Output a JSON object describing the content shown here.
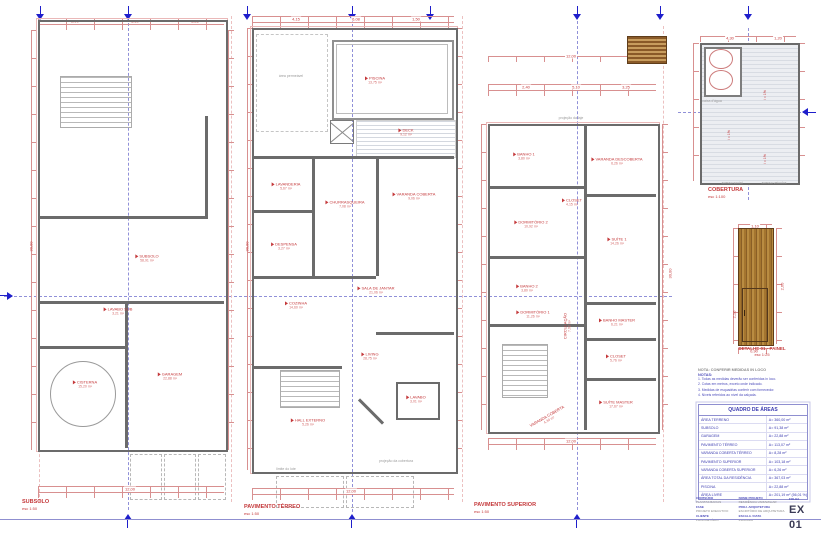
{
  "colors": {
    "dim_red": "#c4393b",
    "marker_blue": "#1e1ecb",
    "table_blue": "#3b3bb0",
    "wall_gray": "#6b6b6b",
    "wood_brown": "#9a6a2e",
    "centerline": "#9090d8"
  },
  "plans": [
    {
      "title": "SUBSOLO",
      "scale": "esc 1:50",
      "rooms": [
        {
          "name": "SUBSOLO",
          "area": "58,91 m²"
        },
        {
          "name": "LAVABO SUB",
          "area": "3,21 m²"
        },
        {
          "name": "CISTERNA",
          "area": "15,20 m²"
        },
        {
          "name": "GARAGEM",
          "area": "22,88 m²"
        }
      ]
    },
    {
      "title": "PAVIMENTO TÉRREO",
      "scale": "esc 1:50",
      "rooms": [
        {
          "name": "PISCINA",
          "area": "13,75 m²"
        },
        {
          "name": "DECK",
          "area": "9,12 m²"
        },
        {
          "name": "LAVANDERIA",
          "area": "5,67 m²"
        },
        {
          "name": "DESPENSA",
          "area": "3,27 m²"
        },
        {
          "name": "CHURRASQUEIRA",
          "area": "7,08 m²"
        },
        {
          "name": "VARANDA COBERTA",
          "area": "9,06 m²"
        },
        {
          "name": "SALA DE JANTAR",
          "area": "21,06 m²"
        },
        {
          "name": "COZINHA",
          "area": "14,60 m²"
        },
        {
          "name": "LIVING",
          "area": "28,75 m²"
        },
        {
          "name": "HALL EXTERNO",
          "area": "5,26 m²"
        },
        {
          "name": "LAVABO",
          "area": "3,01 m²"
        }
      ]
    },
    {
      "title": "PAVIMENTO SUPERIOR",
      "scale": "esc 1:50",
      "rooms": [
        {
          "name": "VARANDA DESCOBERTA",
          "area": "6,26 m²"
        },
        {
          "name": "BANHO 1",
          "area": "3,80 m²"
        },
        {
          "name": "CLOSET",
          "area": "4,15 m²"
        },
        {
          "name": "SUÍTE 1",
          "area": "14,26 m²"
        },
        {
          "name": "DORMITÓRIO 2",
          "area": "10,92 m²"
        },
        {
          "name": "BANHO 2",
          "area": "3,80 m²"
        },
        {
          "name": "BANHO MASTER",
          "area": "6,21 m²"
        },
        {
          "name": "DORMITÓRIO 1",
          "area": "11,26 m²"
        },
        {
          "name": "CIRCULAÇÃO",
          "area": "7,92 m²"
        },
        {
          "name": "CLOSET",
          "area": "5,76 m²"
        },
        {
          "name": "SUÍTE MASTER",
          "area": "17,67 m²"
        },
        {
          "name": "VARANDA COBERTA",
          "area": "4,30 m²"
        }
      ]
    }
  ],
  "cobertura": {
    "title": "COBERTURA",
    "scale": "esc 1:100",
    "slopes": [
      "i = 1%",
      "i = 1%",
      "i = 1%"
    ]
  },
  "detail": {
    "title": "DETALHE 01 - PAINEL",
    "scale": "esc 1:25"
  },
  "annotations": {
    "permeavel": "área permeável",
    "proj_cobertura": "projeção da cobertura",
    "limite": "limite do lote",
    "proj_laje": "projeção da laje",
    "acesso_social": "acesso social",
    "acesso_veiculos": "acesso veículos",
    "caixa_dagua": "caixa d'água"
  },
  "notes": {
    "heading": "NOTA: CONFERIR MEDIDAS IN LOCO",
    "label": "NOTAS:",
    "items": [
      "1. Todas as medidas deverão ser conferidas in loco.",
      "2. Cotas em metros, exceto onde indicado.",
      "3. Medidas de esquadrias conferir com fornecedor.",
      "4. Níveis referidos ao nível da calçada."
    ]
  },
  "areas_table": {
    "title": "QUADRO DE ÁREAS",
    "rows": [
      {
        "label": "ÁREA TERRENO",
        "value": "A= 360,00 m²"
      },
      {
        "label": "SUBSOLO",
        "value": "A= 91,38 m²"
      },
      {
        "label": "GARAGEM",
        "value": "A= 22,88 m²"
      },
      {
        "label": "PAVIMENTO TÉRREO",
        "value": "A= 113,07 m²"
      },
      {
        "label": "VARANDA COBERTA TÉRREO",
        "value": "A= 8,28 m²"
      },
      {
        "label": "PAVIMENTO SUPERIOR",
        "value": "A= 103,18 m²"
      },
      {
        "label": "VARANDA COBERTA SUPERIOR",
        "value": "A= 6,26 m²"
      },
      {
        "label": "ÁREA TOTAL DA RESIDÊNCIA",
        "value": "A= 367,03 m²"
      },
      {
        "label": "PISCINA",
        "value": "A= 22,88 m²"
      },
      {
        "label": "ÁREA LIVRE",
        "value": "A= 201,19 m² (56,01 %)"
      }
    ]
  },
  "titleblock": {
    "folha_label": "FOLHA",
    "sheet_number": "EX 01",
    "fields": [
      {
        "label": "CONTEÚDO",
        "value": "PLANTAS BAIXAS"
      },
      {
        "label": "FASE",
        "value": "PROJETO EXECUTIVO"
      },
      {
        "label": "CLIENTE",
        "value": "PROPRIETÁRIO"
      },
      {
        "label": "NOME PROJETO",
        "value": "RESIDÊNCIA UNIFAMILIAR"
      },
      {
        "label": "PROJ. ARQUITETURA",
        "value": "ESCRITÓRIO DE ARQUITETURA"
      },
      {
        "label": "ESCALA / DATA",
        "value": "INDICADA"
      }
    ]
  },
  "dims": [
    "2,90",
    "5,10",
    "3,25",
    "12,00",
    "30,00",
    "1,50",
    "2,40",
    "4,15",
    "6,08",
    "1,10",
    "2,60",
    "0,90",
    "2,10",
    "4,30",
    "1,20",
    "3,50"
  ]
}
